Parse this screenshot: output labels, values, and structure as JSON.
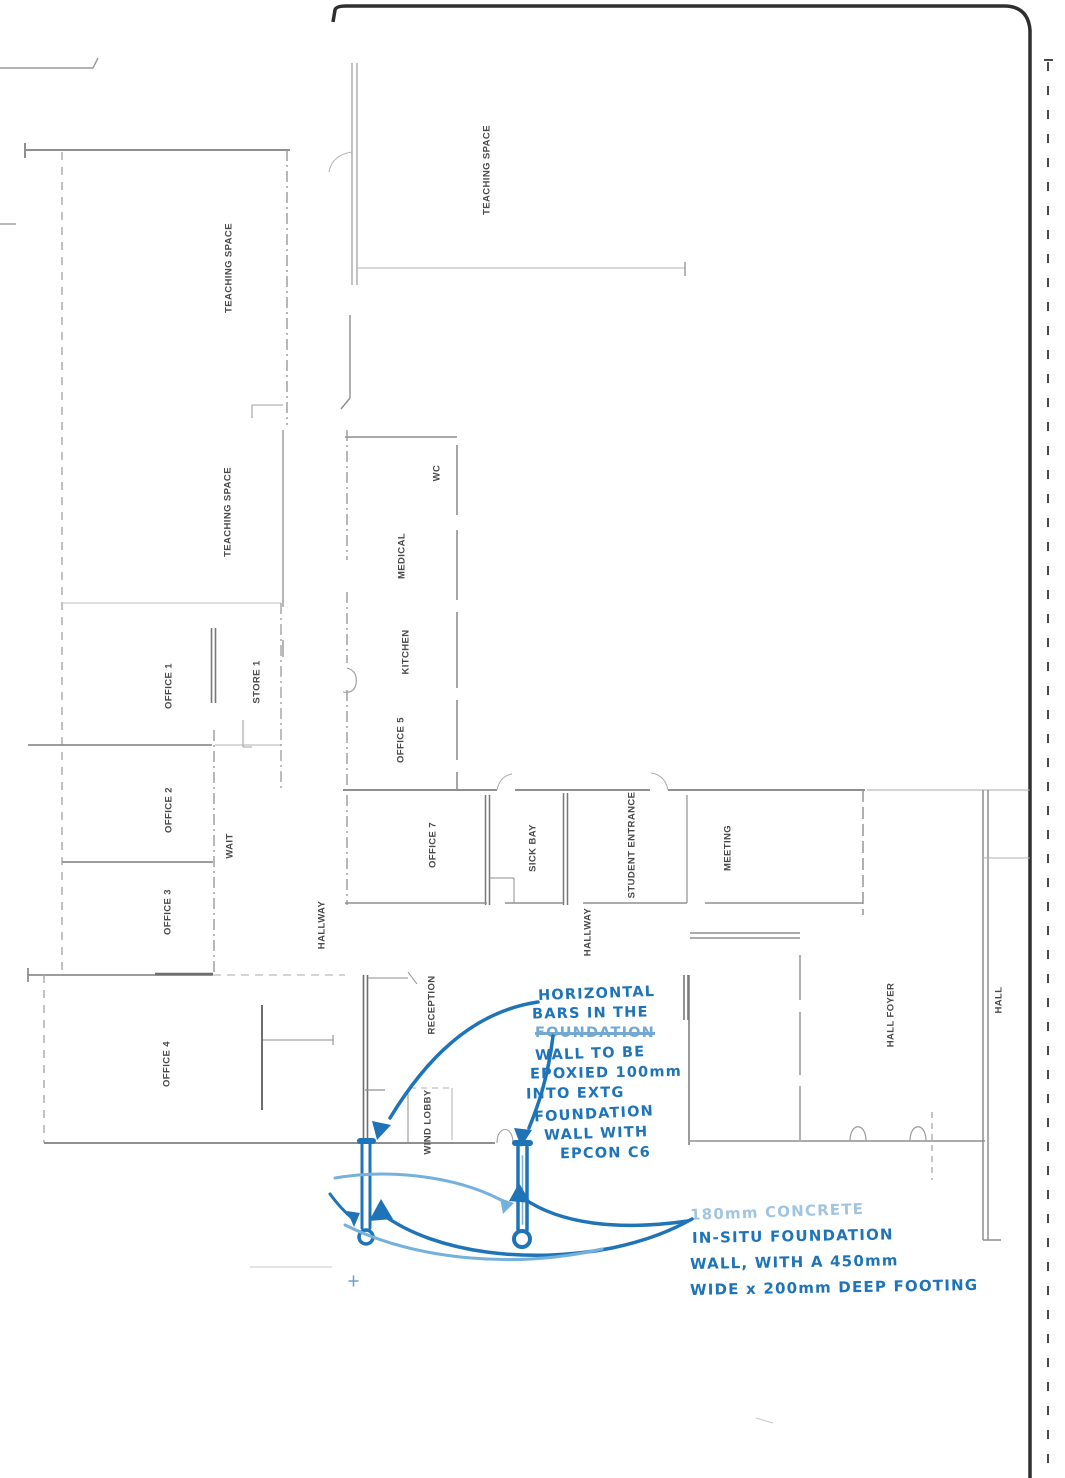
{
  "sheet": {
    "kind": "scanned architectural floor plan with handwritten structural notes",
    "background": "#ffffff",
    "border_color": "#2f2f2f"
  },
  "colors": {
    "wall": "#8f8f8f",
    "wall_light": "#b0b0b0",
    "wall_dark": "#6e6e6e",
    "label_text": "#4a4a4a",
    "ink_blue": "#1f74b8",
    "ink_blue_light": "#74b1dc"
  },
  "rooms": [
    {
      "label": "TEACHING SPACE",
      "x": 487,
      "y": 170
    },
    {
      "label": "TEACHING SPACE",
      "x": 229,
      "y": 268
    },
    {
      "label": "TEACHING SPACE",
      "x": 228,
      "y": 512
    },
    {
      "label": "WC",
      "x": 437,
      "y": 473
    },
    {
      "label": "MEDICAL",
      "x": 402,
      "y": 556
    },
    {
      "label": "KITCHEN",
      "x": 406,
      "y": 652
    },
    {
      "label": "OFFICE 1",
      "x": 169,
      "y": 686
    },
    {
      "label": "STORE 1",
      "x": 257,
      "y": 682
    },
    {
      "label": "OFFICE 5",
      "x": 401,
      "y": 740
    },
    {
      "label": "OFFICE 2",
      "x": 169,
      "y": 810
    },
    {
      "label": "WAIT",
      "x": 230,
      "y": 846
    },
    {
      "label": "OFFICE 7",
      "x": 433,
      "y": 845
    },
    {
      "label": "SICK BAY",
      "x": 533,
      "y": 848
    },
    {
      "label": "STUDENT ENTRANCE",
      "x": 632,
      "y": 845
    },
    {
      "label": "MEETING",
      "x": 728,
      "y": 848
    },
    {
      "label": "OFFICE 3",
      "x": 168,
      "y": 912
    },
    {
      "label": "HALLWAY",
      "x": 322,
      "y": 925
    },
    {
      "label": "HALLWAY",
      "x": 588,
      "y": 932
    },
    {
      "label": "RECEPTION",
      "x": 432,
      "y": 1005
    },
    {
      "label": "OFFICE 4",
      "x": 167,
      "y": 1064
    },
    {
      "label": "WIND LOBBY",
      "x": 428,
      "y": 1122
    },
    {
      "label": "HALL FOYER",
      "x": 891,
      "y": 1015
    },
    {
      "label": "HALL",
      "x": 999,
      "y": 1000
    }
  ],
  "notes": {
    "epoxy_note": {
      "lines": [
        "HORIZONTAL",
        "BARS IN THE",
        "FOUNDATION",
        "WALL TO BE",
        "EPOXIED 100mm",
        "INTO EXTG",
        "FOUNDATION",
        "WALL WITH",
        "EPCON C6"
      ],
      "struck_index": 2
    },
    "footing_note": {
      "lines": [
        "180mm CONCRETE",
        "IN-SITU FOUNDATION",
        "WALL, WITH A 450mm",
        "WIDE x 200mm DEEP FOOTING"
      ],
      "faded_index": 0
    }
  }
}
